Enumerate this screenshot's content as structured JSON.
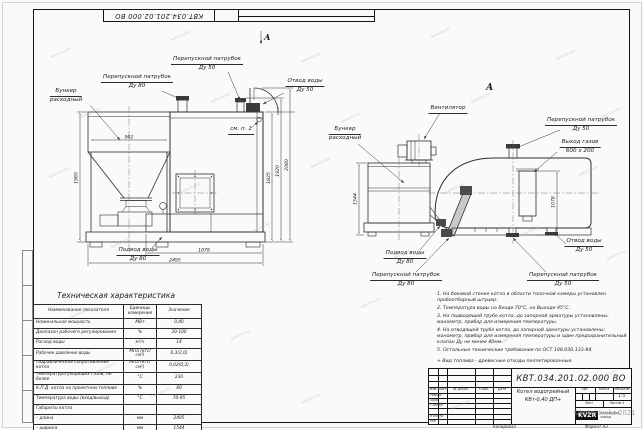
{
  "sheet": {
    "top_doc_number": "КВТ.034.201.02.000  ВО",
    "copied_note": "Копировал",
    "format_note": "Формат А3"
  },
  "watermark": {
    "text": "kotel-kv.kz",
    "copyright": "©kotel-kv.kz 2021",
    "positions": [
      [
        50,
        50
      ],
      [
        170,
        33
      ],
      [
        300,
        55
      ],
      [
        430,
        30
      ],
      [
        555,
        52
      ],
      [
        80,
        110
      ],
      [
        210,
        95
      ],
      [
        340,
        115
      ],
      [
        470,
        95
      ],
      [
        600,
        110
      ],
      [
        48,
        170
      ],
      [
        180,
        185
      ],
      [
        310,
        160
      ],
      [
        445,
        185
      ],
      [
        578,
        168
      ],
      [
        110,
        240
      ],
      [
        250,
        225
      ],
      [
        390,
        252
      ],
      [
        520,
        228
      ],
      [
        606,
        252
      ],
      [
        70,
        310
      ],
      [
        230,
        332
      ],
      [
        360,
        300
      ],
      [
        500,
        335
      ],
      [
        596,
        372
      ],
      [
        150,
        390
      ],
      [
        300,
        396
      ],
      [
        450,
        402
      ],
      [
        95,
        365
      ]
    ]
  },
  "views": {
    "front": {
      "section_label": "А",
      "labels": {
        "bunker": {
          "l1": "Бункер",
          "l2": "расходный"
        },
        "bypass80": {
          "l1": "Перепускной патрубок",
          "l2": "Ду 80"
        },
        "bypass50": {
          "l1": "Перепускной патрубок",
          "l2": "Ду 50"
        },
        "outlet50": {
          "l1": "Отвод воды",
          "l2": "Ду 50"
        },
        "see_note": "см. п. 1",
        "inlet80": {
          "l1": "Подвод воды",
          "l2": "Ду 80"
        }
      },
      "dims": {
        "hopper_width": "902",
        "height": "1960",
        "stoker_length": "1078",
        "length": "2495",
        "h1": "1825",
        "h2": "1920",
        "h3": "2080"
      }
    },
    "side": {
      "view_label": "А",
      "labels": {
        "fan": "Вентилятор",
        "bunker": {
          "l1": "Бункер",
          "l2": "расходный"
        },
        "bypass50_top": {
          "l1": "Перепускной патрубок",
          "l2": "Ду 50"
        },
        "gas_outlet": {
          "l1": "Выход газов",
          "l2": "600 х 200"
        },
        "outlet50": {
          "l1": "Отвод воды",
          "l2": "Ду 50"
        },
        "bypass50_bottom": {
          "l1": "Перепускной патрубок",
          "l2": "Ду 50"
        },
        "bypass80": {
          "l1": "Перепускной патрубок",
          "l2": "Ду 80"
        },
        "inlet80": {
          "l1": "Подвод воды",
          "l2": "Ду 80"
        }
      },
      "dims": {
        "width": "1544",
        "duct_height": "1078"
      }
    }
  },
  "spec_table": {
    "title": "Техническая характеристика",
    "headers": [
      "Наименование показателя",
      "Единицы измерения",
      "Значение"
    ],
    "rows": [
      {
        "name": "Номинальная мощность",
        "unit": "МВт",
        "value": "0,40"
      },
      {
        "name": "Диапазон рабочего регулирования",
        "unit": "%",
        "value": "30-100"
      },
      {
        "name": "Расход воды",
        "unit": "м³/ч",
        "value": "14"
      },
      {
        "name": "Рабочее давление воды",
        "unit": "МПа (кгс/см²)",
        "value": "0,3(3,0)"
      },
      {
        "name": "Гидравлическое сопротивление котла",
        "unit": "МПа (кгс/см²)",
        "value": "0,02(0,2)"
      },
      {
        "name": "Температура уходящих газов, не более",
        "unit": "°С",
        "value": "230"
      },
      {
        "name": "К.П.Д. котла на проектном топливе",
        "unit": "%",
        "value": "80"
      },
      {
        "name": "Температура воды (вход/выход)",
        "unit": "°С",
        "value": "70-95"
      },
      {
        "name": "Габариты котла",
        "unit": "",
        "value": ""
      },
      {
        "name": "– длина",
        "unit": "мм",
        "value": "2495"
      },
      {
        "name": "– ширина",
        "unit": "мм",
        "value": "1544"
      },
      {
        "name": "– высота",
        "unit": "мм",
        "value": "2080"
      }
    ]
  },
  "notes": [
    "1. На боковой стенке котла в области топочной камеры установлен пробоотборный штуцер.",
    "2. Температура воды на Входе 70°С, на Выходе 95°С.",
    "3. На подводящей трубе котла, до запорной арматуры установлены: манометр, прибор для измерения температуры.",
    "4. На отводящей трубе котла, до запорной арматуры установлены: манометр, прибор для измерения температуры и один предохранительный клапан Ду не менее 40мм.",
    "5. Остальные технические требования по ОСТ 108.030.133-84."
  ],
  "footnote": "+ Вид топлива - древесные отходы пеллетированные.",
  "title_block": {
    "doc_number": "КВТ.034.201.02.000  ВО",
    "product_name_1": "Котел водогрейный",
    "product_name_2": "КВт-0,40  ДП+",
    "header_cells": [
      "Изм.",
      "Лист",
      "№ докум.",
      "Подп.",
      "Дата"
    ],
    "roles": [
      "Разраб.",
      "Пров.",
      "Т.контр.",
      "Н.контр.",
      "Утв."
    ],
    "lit_label": "Лит.",
    "mass_label": "Масса",
    "scale_label": "Масштаб",
    "scale_value": "1:5",
    "sheet_label": "Лист",
    "sheets_label": "Листов",
    "sheets_value": "1",
    "logo_text": "KVZR",
    "logo_caption_1": "КОТЕЛЬНЫЙ",
    "logo_caption_2": "ЗАВОД"
  }
}
